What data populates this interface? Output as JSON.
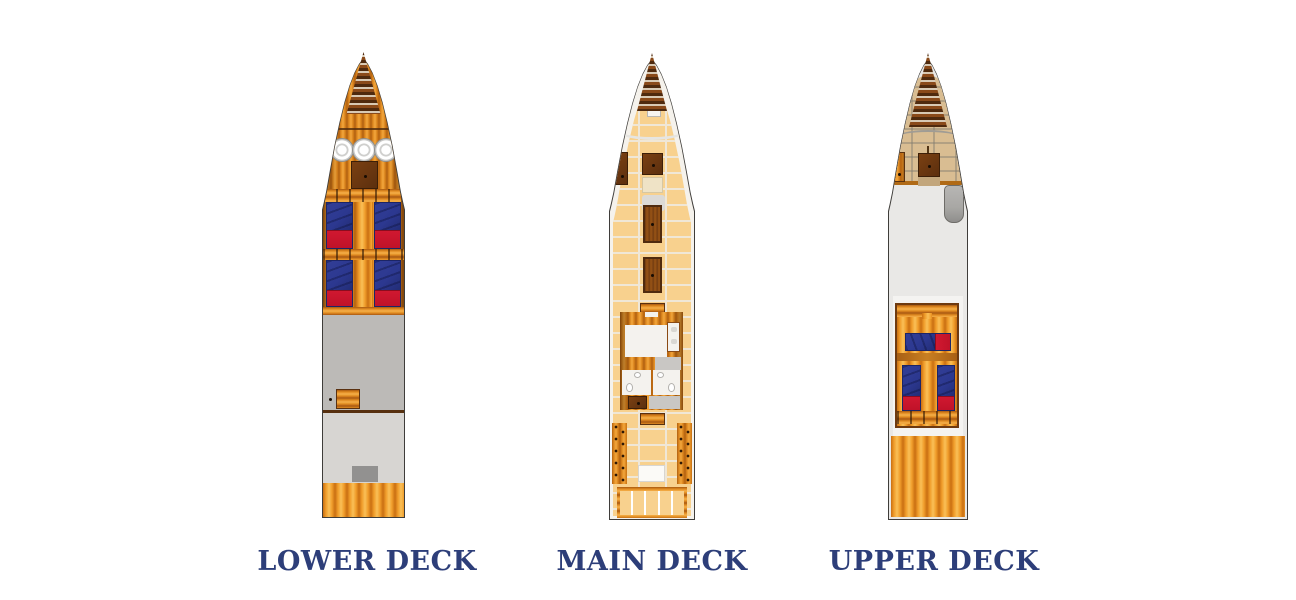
{
  "figure": {
    "type": "yacht-deck-plans",
    "deck_count": 3
  },
  "decks": [
    {
      "id": "lower",
      "label": "LOWER DECK"
    },
    {
      "id": "main",
      "label": "MAIN DECK"
    },
    {
      "id": "upper",
      "label": "UPPER DECK"
    }
  ],
  "colors": {
    "label_text": "#2d3e79",
    "outline": "#3f3d3a",
    "wood_light": "#f5b04a",
    "wood_mid": "#e08a20",
    "wood_dark": "#a85812",
    "wood_frame": "#6e3a10",
    "dark_box": "#5c2f0e",
    "deck_peach": "#f8d18e",
    "deck_seam": "#f0e7d6",
    "deck_tan": "#d9bd92",
    "gray_dark": "#bcbab7",
    "gray_light": "#d7d5d2",
    "gray_box": "#929190",
    "pad_white": "#f4f3f1",
    "hull_cream": "#f5f2ec",
    "bed_blue": "#2c3890",
    "bed_blue_dark": "#1c2566",
    "bed_red": "#c01229",
    "tender_gray": "#a8a7a4"
  }
}
